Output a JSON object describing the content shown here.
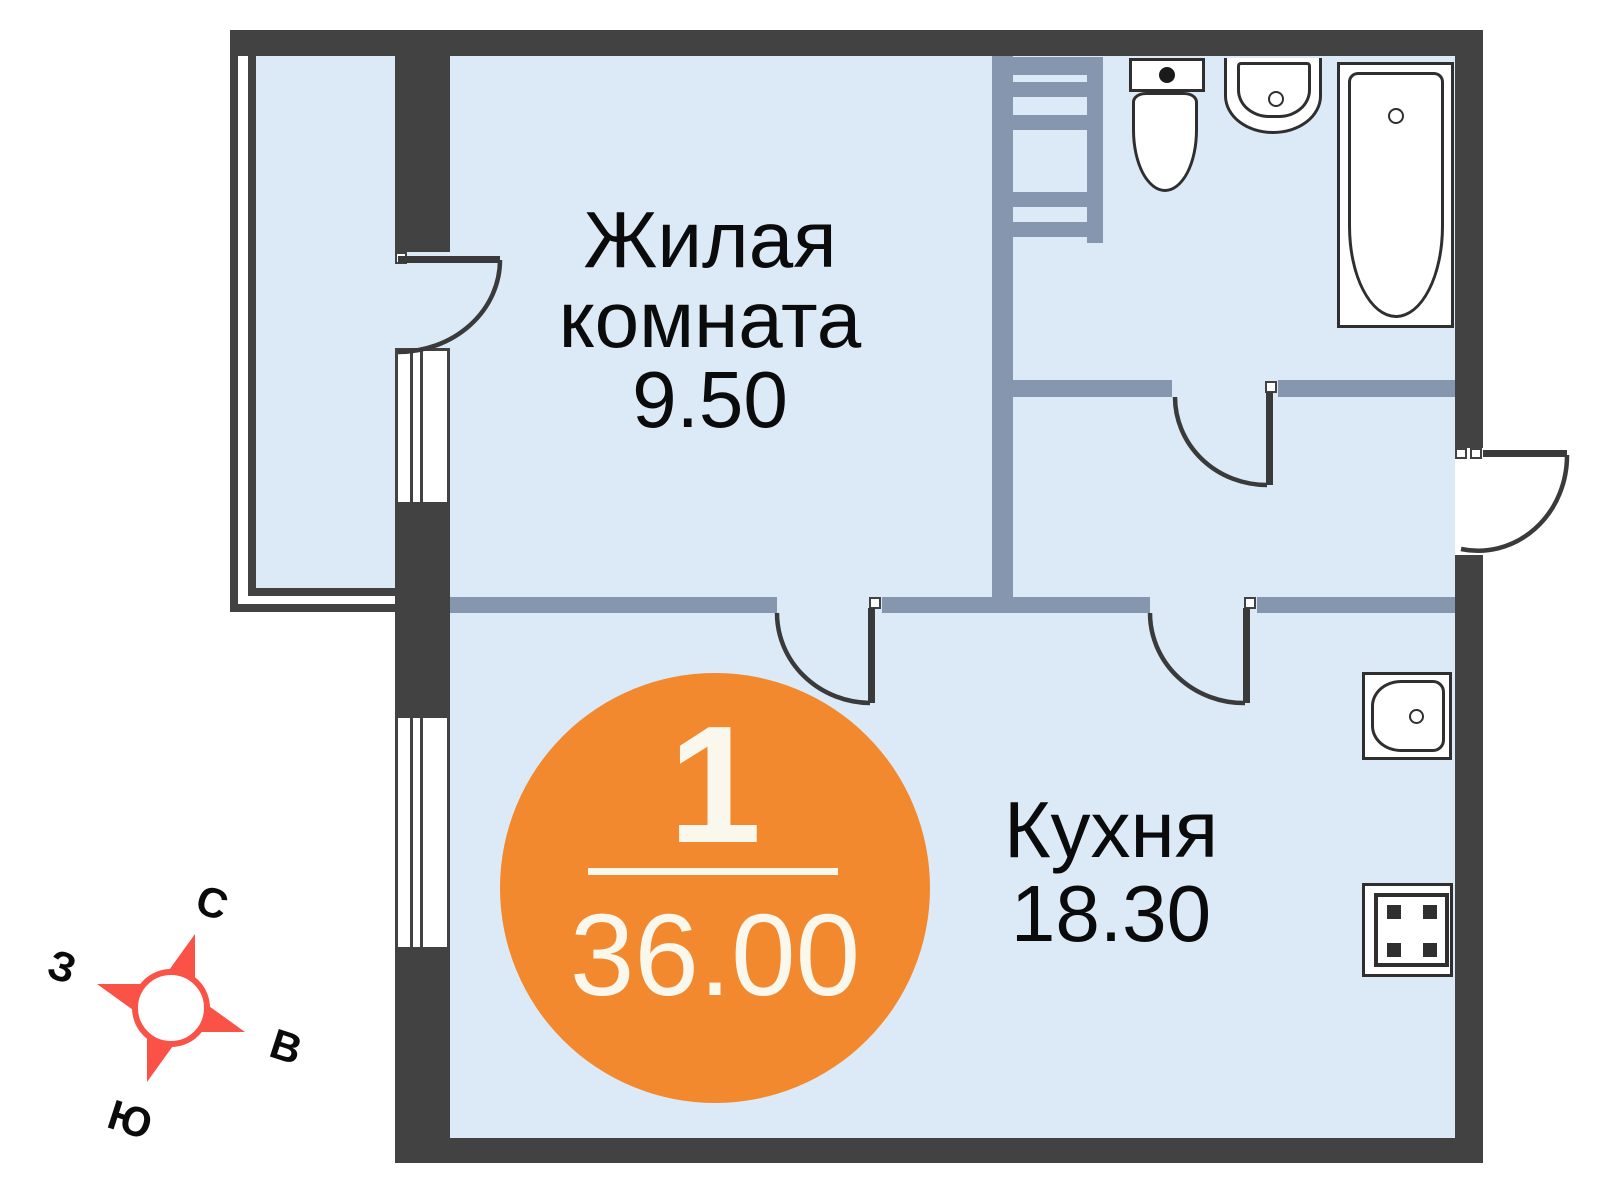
{
  "floorplan": {
    "rooms": {
      "living": {
        "name_line1": "Жилая",
        "name_line2": "комната",
        "area": "9.50"
      },
      "kitchen": {
        "name": "Кухня",
        "area": "18.30"
      }
    },
    "badge": {
      "room_count": "1",
      "total_area": "36.00"
    },
    "compass": {
      "north": "С",
      "east": "В",
      "south": "Ю",
      "west": "З"
    },
    "colors": {
      "outer_wall": "#424242",
      "partition": "#8696AF",
      "room_fill": "#DCEAF7",
      "badge_orange": "#F2892E",
      "badge_text": "#FAF7EC",
      "compass_red": "#FA5247",
      "text": "#0b0b0b",
      "background": "#ffffff"
    },
    "fixtures": {
      "bathroom": [
        "vent-ladder",
        "toilet",
        "sink",
        "bathtub"
      ],
      "kitchen": [
        "kitchen-sink",
        "stove"
      ]
    }
  }
}
